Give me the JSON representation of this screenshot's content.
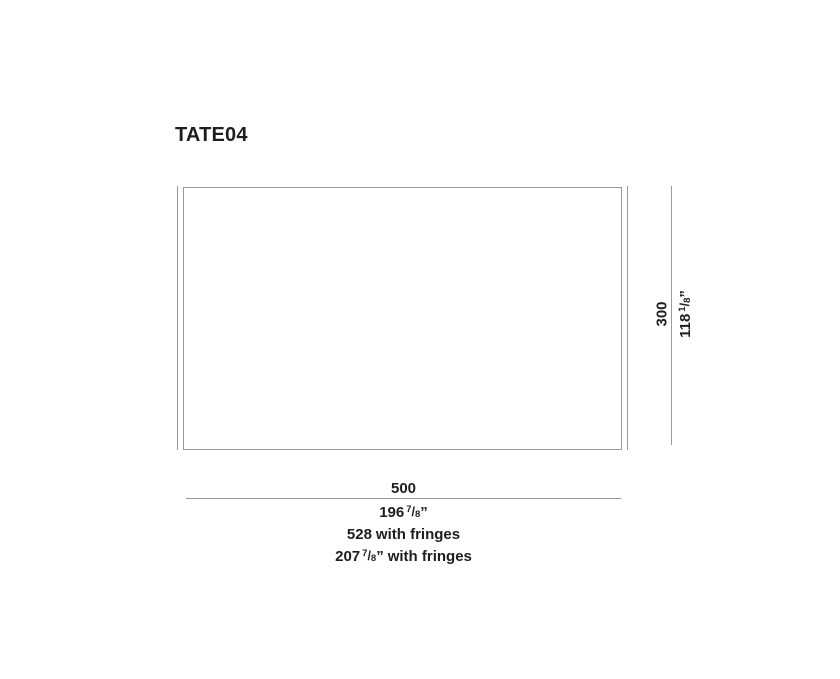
{
  "title": "TATE04",
  "colors": {
    "line_gray": "#9a9a9a",
    "text": "#1e1e1e",
    "background": "#ffffff"
  },
  "diagram": {
    "height": {
      "cm": "300",
      "in_whole": "118",
      "frac_num": "1",
      "frac_slash": "/",
      "frac_den": "8",
      "inch_mark": "”"
    },
    "width": {
      "cm": "500",
      "in_whole": "196",
      "frac_num": "7",
      "frac_slash": "/",
      "frac_den": "8",
      "inch_mark": "”"
    },
    "width_with_fringes": {
      "cm": "528",
      "cm_suffix": "with fringes",
      "in_whole": "207",
      "frac_num": "7",
      "frac_slash": "/",
      "frac_den": "8",
      "inch_mark": "”",
      "in_suffix": "with fringes"
    }
  }
}
